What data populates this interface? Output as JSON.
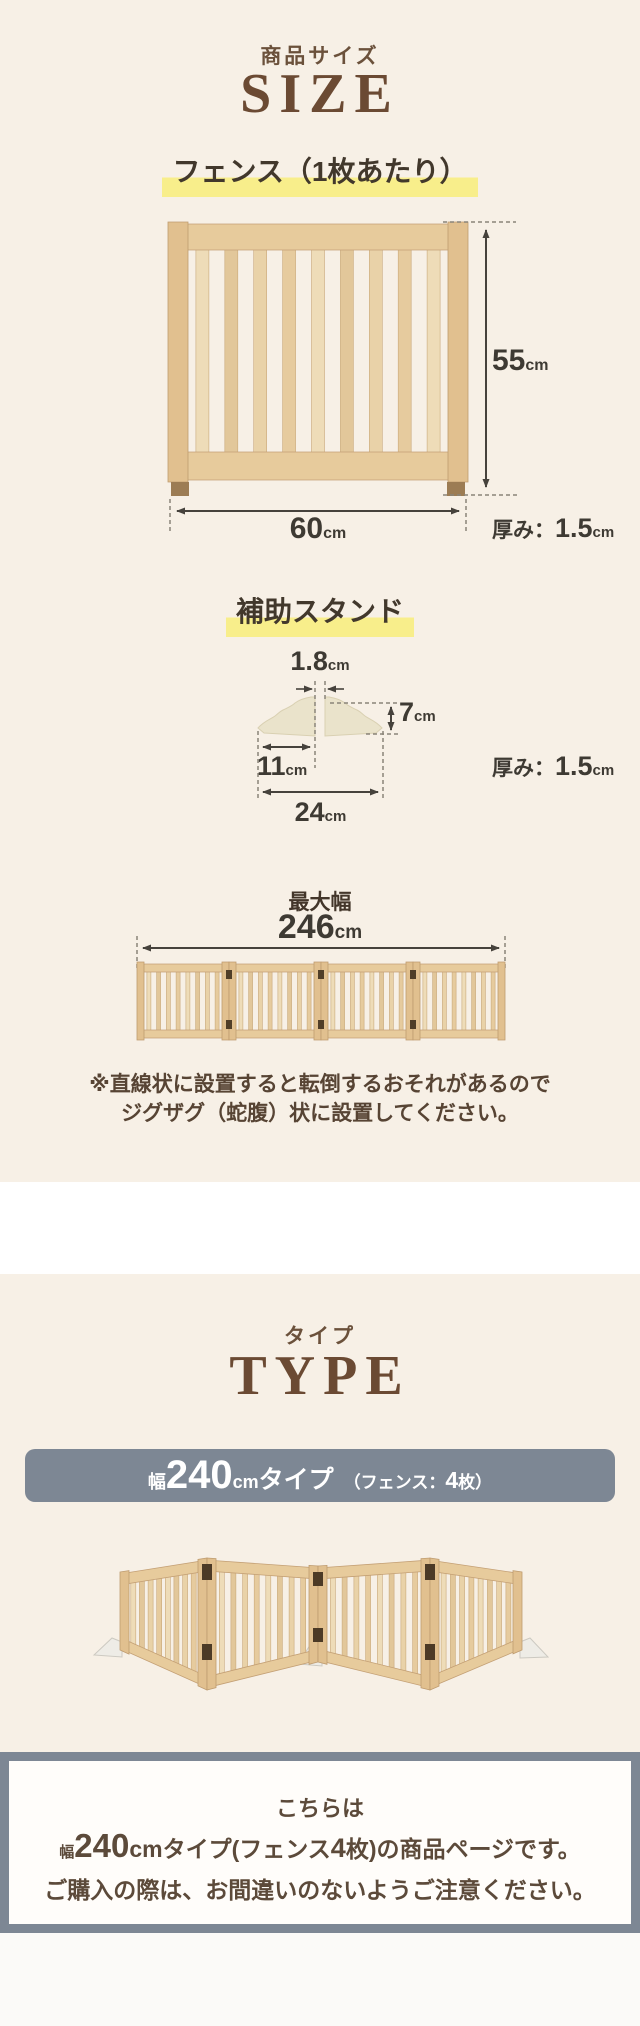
{
  "size": {
    "subtitle": "商品サイズ",
    "title": "SIZE",
    "fence": {
      "heading": "フェンス（1枚あたり）",
      "height": {
        "value": "55",
        "unit": "cm"
      },
      "width": {
        "value": "60",
        "unit": "cm"
      },
      "thickness": {
        "label": "厚み：",
        "value": "1.5",
        "unit": "cm"
      }
    },
    "stand": {
      "heading": "補助スタンド",
      "slot": {
        "value": "1.8",
        "unit": "cm"
      },
      "height": {
        "value": "7",
        "unit": "cm"
      },
      "inner_width": {
        "value": "11",
        "unit": "cm"
      },
      "width": {
        "value": "24",
        "unit": "cm"
      },
      "thickness": {
        "label": "厚み：",
        "value": "1.5",
        "unit": "cm"
      }
    },
    "max_width": {
      "label": "最大幅",
      "value": "246",
      "unit": "cm"
    },
    "note_line1": "※直線状に設置すると転倒するおそれがあるので",
    "note_line2": "ジグザグ（蛇腹）状に設置してください。"
  },
  "type": {
    "subtitle": "タイプ",
    "title": "TYPE",
    "banner": {
      "prefix": "幅",
      "value": "240",
      "unit": "cm",
      "suffix": "タイプ",
      "note_open": "（フェンス：",
      "note_value": "4",
      "note_close": "枚）"
    }
  },
  "footer": {
    "line1": "こちらは",
    "line2": {
      "prefix": "幅",
      "value": "240",
      "mid": "cmタイプ(フェンス",
      "count": "4",
      "suffix": "枚)の商品ページです。"
    },
    "line3": "ご購入の際は、お間違いのないようご注意ください。"
  },
  "colors": {
    "background_cream": "#f7f0e6",
    "accent_brown": "#6b4a33",
    "heading_dark": "#42382c",
    "highlight_yellow": "#f8ee8b",
    "banner_gray": "#7d8794",
    "wood": "#e8cda1"
  }
}
